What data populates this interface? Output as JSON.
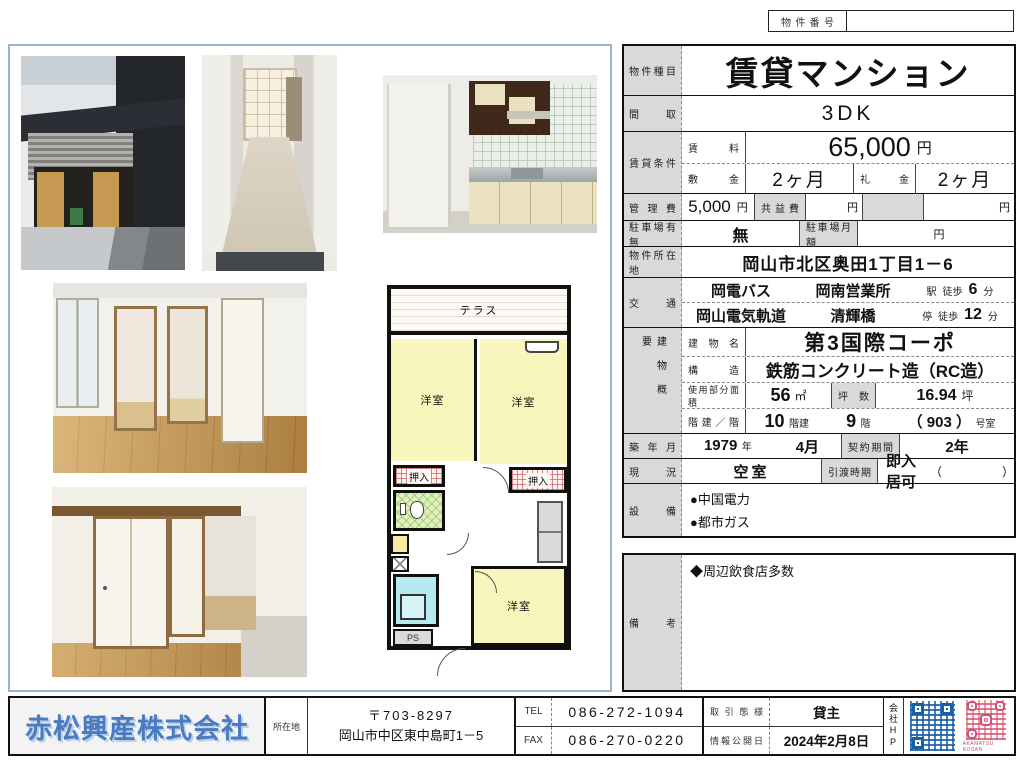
{
  "page": {
    "property_no_label": "物件番号",
    "property_no_value": ""
  },
  "main": {
    "type_label": "物件種目",
    "type_value": "賃貸マンション",
    "madori_label": "間取",
    "madori_value": "3DK",
    "cond_label": "賃貸条件",
    "rent_label": "賃料",
    "rent_value": "65,000",
    "rent_unit": "円",
    "shikikin_label": "敷金",
    "shikikin_value": "2ヶ月",
    "reikin_label": "礼金",
    "reikin_value": "2ヶ月",
    "kanrihi_label": "管理費",
    "kanrihi_value": "5,000",
    "kanrihi_unit": "円",
    "kyoueki_label": "共益費",
    "kyoueki_value": "",
    "kyoueki_unit": "円",
    "kyoueki_unit2": "円",
    "parking_label": "駐車場有無",
    "parking_value": "無",
    "parking_month_label": "駐車場月額",
    "parking_month_value": "",
    "parking_month_unit": "円",
    "addr_label": "物件所在地",
    "addr_value": "岡山市北区奥田1丁目1－6",
    "kotsu_label": "交通",
    "kotsu1_line": "岡電バス",
    "kotsu1_st": "岡南営業所",
    "kotsu1_type": "駅",
    "kotsu1_walk": "徒歩",
    "kotsu1_min": "6",
    "kotsu1_unit": "分",
    "kotsu2_line": "岡山電気軌道",
    "kotsu2_st": "清輝橋",
    "kotsu2_type": "停",
    "kotsu2_walk": "徒歩",
    "kotsu2_min": "12",
    "kotsu2_unit": "分",
    "bldg_label": "建物概要",
    "bname_label": "建物名",
    "bname_value": "第3国際コーポ",
    "struct_label": "構造",
    "struct_value": "鉄筋コンクリート造（RC造）",
    "area_label": "使用部分面積",
    "area_value": "56",
    "area_unit": "㎡",
    "tsubo_label": "坪数",
    "tsubo_value": "16.94",
    "tsubo_unit": "坪",
    "floors_label": "階建／階",
    "floors_total": "10",
    "floors_total_unit": "階建",
    "floors_floor": "9",
    "floors_floor_unit": "階",
    "floors_room": "（ 903 ）",
    "floors_room_unit": "号室",
    "built_label": "築年月",
    "built_year": "1979",
    "built_year_unit": "年",
    "built_month": "4月",
    "contract_label": "契約期間",
    "contract_value": "2年",
    "status_label": "現況",
    "status_value": "空室",
    "handover_label": "引渡時期",
    "handover_value": "即入居可",
    "handover_paren": "（　　　　　）",
    "setsubi_label": "設備",
    "setsubi_items": [
      "●中国電力",
      "●都市ガス"
    ]
  },
  "remarks": {
    "label": "備考",
    "item": "◆周辺飲食店多数"
  },
  "plan": {
    "terrace": "テラス",
    "room1": "洋室",
    "room2": "洋室",
    "room3": "洋室",
    "oshiire1": "押入",
    "oshiire2": "押入",
    "ps": "PS"
  },
  "footer": {
    "company": "赤松興産株式会社",
    "addr_label": "所在地",
    "postal": "〒703-8297",
    "address": "岡山市中区東中島町1－5",
    "tel_label": "TEL",
    "tel_value": "086-272-1094",
    "fax_label": "FAX",
    "fax_value": "086-270-0220",
    "deal_label": "取引態様",
    "deal_value": "貸主",
    "pub_label": "情報公開日",
    "pub_value": "2024年2月8日",
    "hp_label": "会社HP",
    "qr_caption": "AKAMATSU KOSAN"
  }
}
